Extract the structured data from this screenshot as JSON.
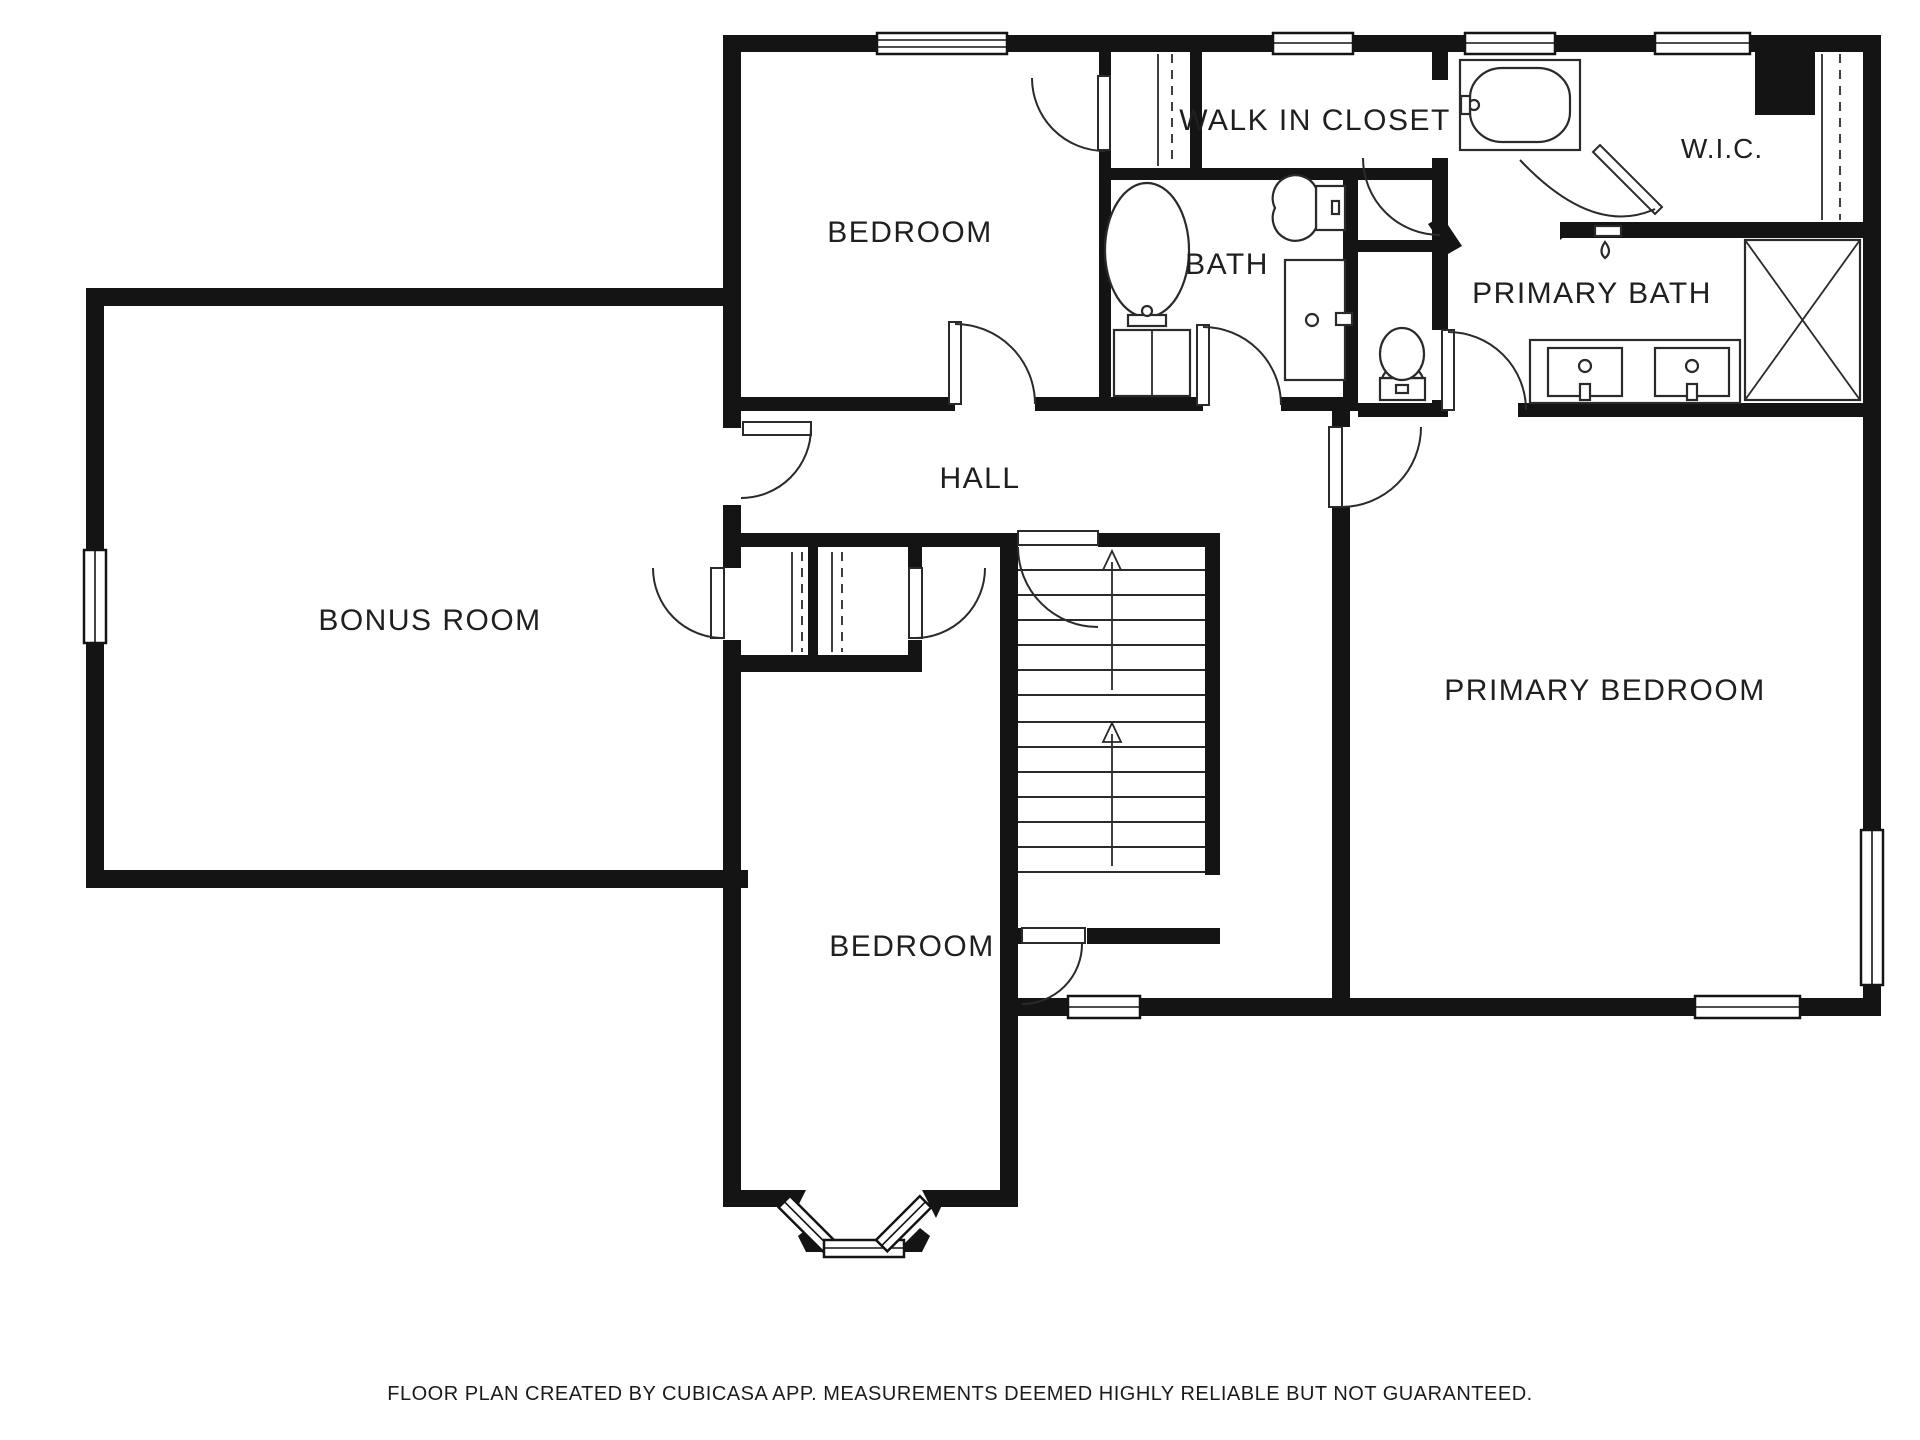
{
  "title": "Floor plan (upper level)",
  "footer": {
    "text": "FLOOR PLAN CREATED BY CUBICASA APP. MEASUREMENTS DEEMED HIGHLY RELIABLE BUT NOT GUARANTEED."
  },
  "rooms": {
    "bedroom_top": {
      "label": "BEDROOM"
    },
    "walk_in_closet": {
      "label": "WALK IN CLOSET"
    },
    "bath": {
      "label": "BATH"
    },
    "primary_bath": {
      "label": "PRIMARY BATH"
    },
    "wic": {
      "label": "W.I.C."
    },
    "bonus_room": {
      "label": "BONUS ROOM"
    },
    "hall": {
      "label": "HALL"
    },
    "primary_bedroom": {
      "label": "PRIMARY BEDROOM"
    },
    "bedroom_bottom": {
      "label": "BEDROOM"
    }
  },
  "colors": {
    "wall": "#141414",
    "background": "#ffffff",
    "line": "#2a2a2a"
  },
  "fixtures": [
    "bathtub-oval",
    "toilet",
    "vanity-sink",
    "linen-cabinet",
    "soaking-tub",
    "water-closet-toilet",
    "double-vanity-sinks",
    "shower-with-cross",
    "shower-head",
    "stairs-up-arrows",
    "closet-rod-dashed-lines",
    "bay-window",
    "windows",
    "door-swing-arcs"
  ]
}
